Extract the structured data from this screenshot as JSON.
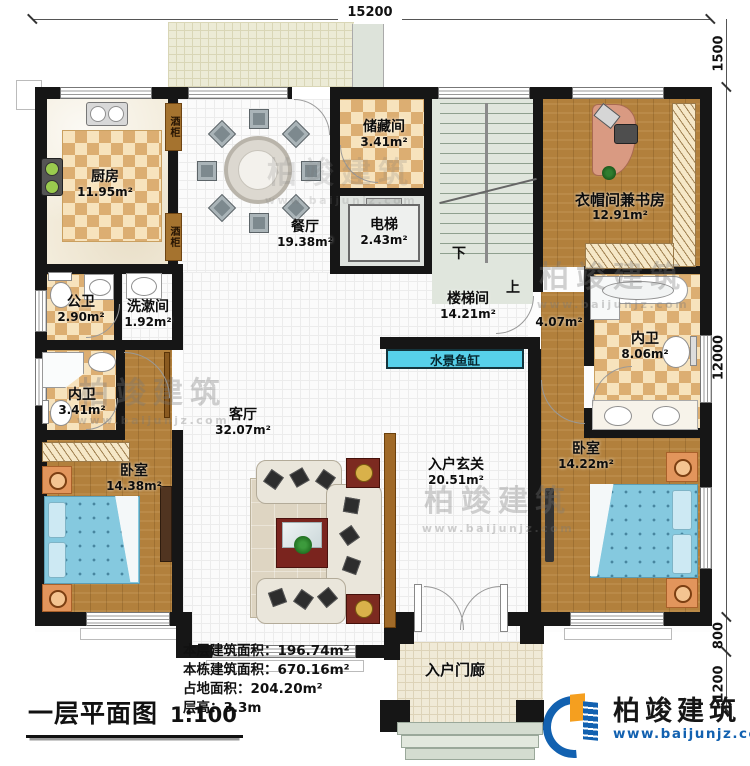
{
  "dimensions": {
    "top": "15200",
    "right_top": "1500",
    "right_main": "12000",
    "right_lower": "800",
    "right_bottom": "1200"
  },
  "rooms": {
    "kitchen": {
      "name": "厨房",
      "area": "11.95m²"
    },
    "dining": {
      "name": "餐厅",
      "area": "19.38m²"
    },
    "storage": {
      "name": "储藏间",
      "area": "3.41m²"
    },
    "elevator": {
      "name": "电梯",
      "area": "2.43m²"
    },
    "stair_hall": {
      "name": "楼梯间",
      "area": "14.21m²"
    },
    "study": {
      "name": "衣帽间兼书房",
      "area": "12.91m²"
    },
    "corridor": {
      "area": "4.07m²"
    },
    "bath_right": {
      "name": "内卫",
      "area": "8.06m²"
    },
    "bedroom_right": {
      "name": "卧室",
      "area": "14.22m²"
    },
    "public_bath": {
      "name": "公卫",
      "area": "2.90m²"
    },
    "washroom": {
      "name": "洗漱间",
      "area": "1.92m²"
    },
    "bath_left": {
      "name": "内卫",
      "area": "3.41m²"
    },
    "bedroom_left": {
      "name": "卧室",
      "area": "14.38m²"
    },
    "living": {
      "name": "客厅",
      "area": "32.07m²"
    },
    "foyer": {
      "name": "入户玄关",
      "area": "20.51m²"
    },
    "porch": {
      "name": "入户门廊"
    }
  },
  "features": {
    "wine_cabinet": "酒柜",
    "aquarium": "水景鱼缸",
    "stair_down": "下",
    "stair_up": "上"
  },
  "title_block": {
    "title": "一层平面图",
    "scale": "1:100"
  },
  "stats": [
    {
      "label": "本层建筑面积：",
      "value": "196.74m²"
    },
    {
      "label": "本栋建筑面积：",
      "value": "670.16m²"
    },
    {
      "label": "占地面积：",
      "value": "204.20m²"
    },
    {
      "label": "层高：",
      "value": "3.3m"
    }
  ],
  "branding": {
    "company": "柏竣建筑",
    "website": "www.baijunjz.com"
  },
  "watermark": {
    "text": "柏竣建筑",
    "site": "www.baijunjz.com"
  },
  "palette": {
    "wall": "#161616",
    "wood_floor": "#b2803c",
    "tile_tan": "#dcae72",
    "aquarium_cyan": "#57d0e9",
    "bed_blue": "#85c9df",
    "brand_blue": "#1261b0",
    "brand_orange": "#f59f1f"
  }
}
